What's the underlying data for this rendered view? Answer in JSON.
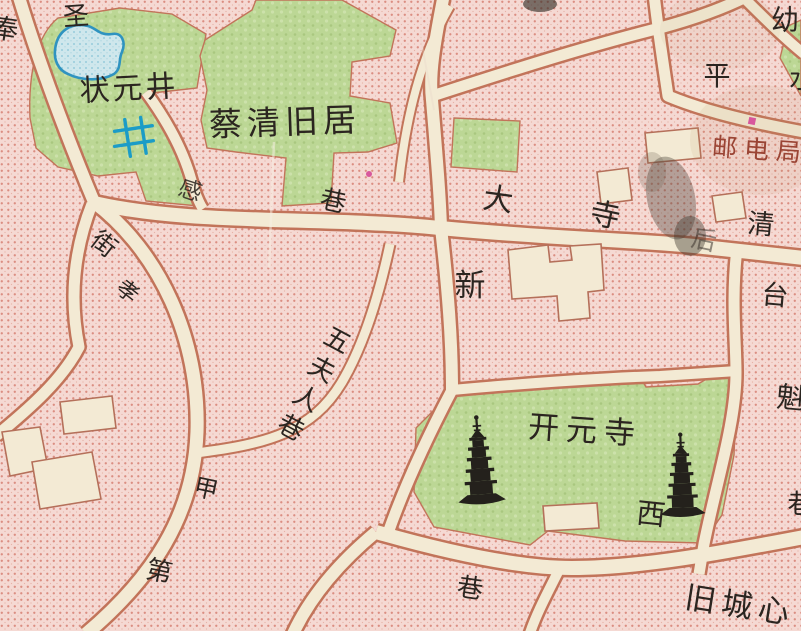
{
  "map": {
    "labels": [
      {
        "name": "feng",
        "text": "奉",
        "x": 5,
        "y": 30,
        "size": 27,
        "rot": 8
      },
      {
        "name": "sheng",
        "text": "圣",
        "x": 76,
        "y": 17,
        "size": 26,
        "rot": -4
      },
      {
        "name": "zhuangyuan-well",
        "text": "状元井",
        "x": 129,
        "y": 89,
        "size": 30,
        "rot": -3,
        "spacing": 3
      },
      {
        "name": "caiqing-residence",
        "text": "蔡清旧居",
        "x": 285,
        "y": 122,
        "size": 33,
        "rot": -2,
        "spacing": 5
      },
      {
        "name": "gan",
        "text": "感",
        "x": 190,
        "y": 191,
        "size": 23,
        "rot": 18,
        "opacity": 0.85
      },
      {
        "name": "xiang-northwest",
        "text": "巷",
        "x": 333,
        "y": 202,
        "size": 26,
        "rot": 12
      },
      {
        "name": "jie",
        "text": "街",
        "x": 104,
        "y": 244,
        "size": 25,
        "rot": 38
      },
      {
        "name": "xiao",
        "text": "孝",
        "x": 127,
        "y": 292,
        "size": 22,
        "rot": 38
      },
      {
        "name": "da",
        "text": "大",
        "x": 498,
        "y": 200,
        "size": 30,
        "rot": 8
      },
      {
        "name": "si",
        "text": "寺",
        "x": 605,
        "y": 216,
        "size": 30,
        "rot": 12
      },
      {
        "name": "hou",
        "text": "后",
        "x": 704,
        "y": 240,
        "size": 25,
        "rot": 12,
        "opacity": 0.5
      },
      {
        "name": "qing",
        "text": "清",
        "x": 761,
        "y": 225,
        "size": 27,
        "rot": 5
      },
      {
        "name": "tai",
        "text": "台",
        "x": 775,
        "y": 296,
        "size": 27,
        "rot": 5
      },
      {
        "name": "kui",
        "text": "魁",
        "x": 791,
        "y": 398,
        "size": 29,
        "rot": 5
      },
      {
        "name": "xiang-east-edge",
        "text": "巷",
        "x": 801,
        "y": 505,
        "size": 27,
        "rot": 0
      },
      {
        "name": "ping",
        "text": "平",
        "x": 717,
        "y": 77,
        "size": 27,
        "rot": 0
      },
      {
        "name": "shui",
        "text": "水",
        "x": 802,
        "y": 80,
        "size": 26,
        "rot": 0
      },
      {
        "name": "you",
        "text": "幼",
        "x": 785,
        "y": 20,
        "size": 28,
        "rot": 0
      },
      {
        "name": "post-telecom-office",
        "text": "邮电局",
        "x": 760,
        "y": 150,
        "size": 25,
        "rot": 4,
        "spacing": 7,
        "color": "#9a4434"
      },
      {
        "name": "xin",
        "text": "新",
        "x": 470,
        "y": 286,
        "size": 31,
        "rot": 0
      },
      {
        "name": "wufuren-lane",
        "text": "五夫人巷",
        "x": 337,
        "y": 341,
        "size": 26,
        "rot": 28,
        "dir": "v"
      },
      {
        "name": "kaiyuan-temple",
        "text": "开元寺",
        "x": 585,
        "y": 431,
        "size": 31,
        "rot": 4,
        "spacing": 7
      },
      {
        "name": "xi",
        "text": "西",
        "x": 651,
        "y": 514,
        "size": 29,
        "rot": 6
      },
      {
        "name": "jia",
        "text": "甲",
        "x": 206,
        "y": 489,
        "size": 24,
        "rot": 12
      },
      {
        "name": "di",
        "text": "第",
        "x": 159,
        "y": 572,
        "size": 26,
        "rot": 12
      },
      {
        "name": "xiang-south",
        "text": "巷",
        "x": 470,
        "y": 589,
        "size": 26,
        "rot": 8
      },
      {
        "name": "jiucheng-xin",
        "text": "旧城心",
        "x": 740,
        "y": 606,
        "size": 31,
        "rot": 9,
        "spacing": 6
      }
    ],
    "icons": [
      {
        "name": "pagoda-icon-left",
        "x": 482,
        "y": 499,
        "scale": 0.95,
        "rot": -4
      },
      {
        "name": "pagoda-icon-right",
        "x": 683,
        "y": 512,
        "scale": 0.9,
        "rot": -2
      },
      {
        "name": "well-icon",
        "x": 134,
        "y": 137,
        "scale": 1,
        "rot": -4
      }
    ],
    "marks": [
      {
        "name": "magenta-square-mark",
        "shape": "square",
        "x": 752,
        "y": 121,
        "size": 7
      },
      {
        "name": "magenta-dot-mark",
        "shape": "dot",
        "x": 369,
        "y": 174,
        "size": 3
      }
    ],
    "colors": {
      "pink_block": "#f5d9d3",
      "pink_dot": "#db8e82",
      "road_fill": "#f3ead4",
      "road_border": "#c2745a",
      "green_area": "#bcd795",
      "pond_fill": "#cfe7ec",
      "pond_outline": "#2f93c0",
      "ink": "#2b2520",
      "red_label": "#9a4434",
      "well_blue": "#1b9cc7",
      "magenta_mark": "#d8579c"
    }
  }
}
